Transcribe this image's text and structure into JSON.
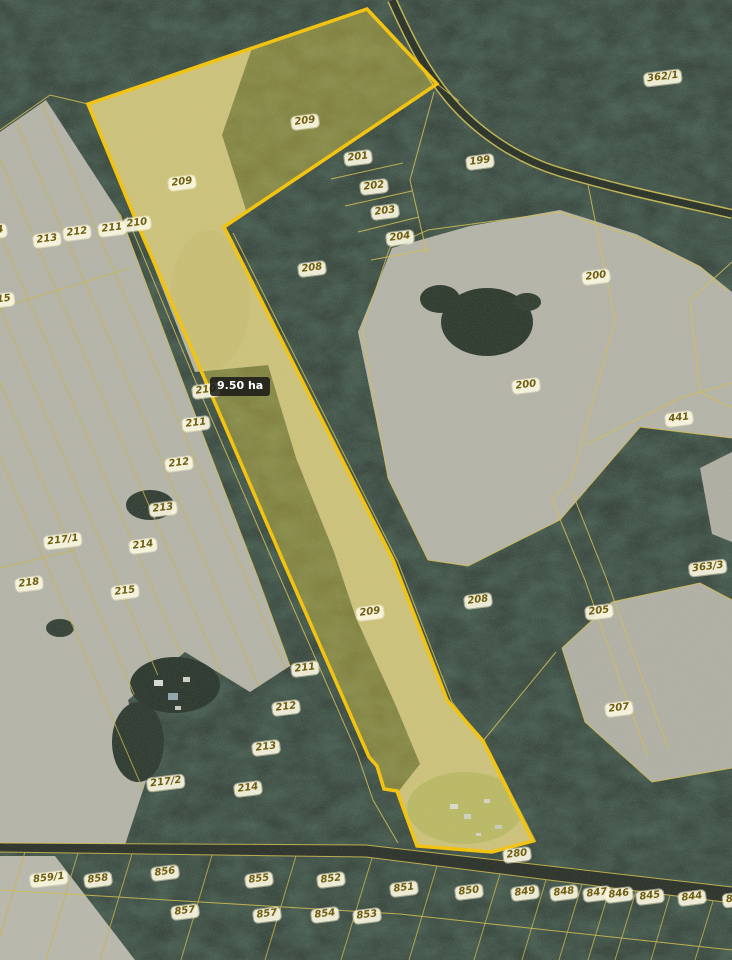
{
  "map": {
    "area_tag": "9.50 ha",
    "highlighted_parcel": {
      "number": "209",
      "area_label": "9.50 ha"
    },
    "colors": {
      "highlight_outline": "#f2c411",
      "highlight_fill": "rgba(234,216,70,0.40)",
      "boundary_line": "#d2c055",
      "label_text": "#6e5c10",
      "area_tag_bg": "#181816"
    },
    "labels": [
      {
        "t": "362/1",
        "x": 663,
        "y": 78
      },
      {
        "t": "209",
        "x": 305,
        "y": 122
      },
      {
        "t": "201",
        "x": 358,
        "y": 158
      },
      {
        "t": "199",
        "x": 480,
        "y": 162
      },
      {
        "t": "209",
        "x": 182,
        "y": 183
      },
      {
        "t": "202",
        "x": 374,
        "y": 187
      },
      {
        "t": "203",
        "x": 385,
        "y": 212
      },
      {
        "t": "210",
        "x": 137,
        "y": 224
      },
      {
        "t": "211",
        "x": 112,
        "y": 229
      },
      {
        "t": "4",
        "x": 0,
        "y": 231
      },
      {
        "t": "212",
        "x": 77,
        "y": 233
      },
      {
        "t": "204",
        "x": 400,
        "y": 238
      },
      {
        "t": "213",
        "x": 47,
        "y": 240
      },
      {
        "t": "208",
        "x": 312,
        "y": 269
      },
      {
        "t": "200",
        "x": 596,
        "y": 277
      },
      {
        "t": "15",
        "x": 4,
        "y": 300
      },
      {
        "t": "200",
        "x": 526,
        "y": 386
      },
      {
        "t": "210",
        "x": 206,
        "y": 391
      },
      {
        "t": "441",
        "x": 679,
        "y": 419
      },
      {
        "t": "211",
        "x": 196,
        "y": 424
      },
      {
        "t": "212",
        "x": 179,
        "y": 464
      },
      {
        "t": "213",
        "x": 163,
        "y": 509
      },
      {
        "t": "217/1",
        "x": 63,
        "y": 541
      },
      {
        "t": "214",
        "x": 143,
        "y": 546
      },
      {
        "t": "363/3",
        "x": 708,
        "y": 568
      },
      {
        "t": "218",
        "x": 29,
        "y": 584
      },
      {
        "t": "215",
        "x": 125,
        "y": 592
      },
      {
        "t": "208",
        "x": 478,
        "y": 601
      },
      {
        "t": "205",
        "x": 599,
        "y": 612
      },
      {
        "t": "209",
        "x": 370,
        "y": 613
      },
      {
        "t": "211",
        "x": 305,
        "y": 669
      },
      {
        "t": "212",
        "x": 286,
        "y": 708
      },
      {
        "t": "207",
        "x": 619,
        "y": 709
      },
      {
        "t": "213",
        "x": 266,
        "y": 748
      },
      {
        "t": "217/2",
        "x": 166,
        "y": 783
      },
      {
        "t": "214",
        "x": 248,
        "y": 789
      },
      {
        "t": "280",
        "x": 517,
        "y": 855
      },
      {
        "t": "856",
        "x": 165,
        "y": 873
      },
      {
        "t": "859/1",
        "x": 49,
        "y": 879
      },
      {
        "t": "858",
        "x": 98,
        "y": 880
      },
      {
        "t": "855",
        "x": 259,
        "y": 880
      },
      {
        "t": "852",
        "x": 331,
        "y": 880
      },
      {
        "t": "851",
        "x": 404,
        "y": 889
      },
      {
        "t": "850",
        "x": 469,
        "y": 892
      },
      {
        "t": "849",
        "x": 525,
        "y": 893
      },
      {
        "t": "848",
        "x": 564,
        "y": 893
      },
      {
        "t": "847",
        "x": 597,
        "y": 894
      },
      {
        "t": "846",
        "x": 619,
        "y": 895
      },
      {
        "t": "845",
        "x": 650,
        "y": 897
      },
      {
        "t": "844",
        "x": 692,
        "y": 898
      },
      {
        "t": "84",
        "x": 733,
        "y": 900
      },
      {
        "t": "857",
        "x": 185,
        "y": 912
      },
      {
        "t": "857",
        "x": 267,
        "y": 915
      },
      {
        "t": "854",
        "x": 325,
        "y": 915
      },
      {
        "t": "853",
        "x": 367,
        "y": 916
      }
    ]
  }
}
